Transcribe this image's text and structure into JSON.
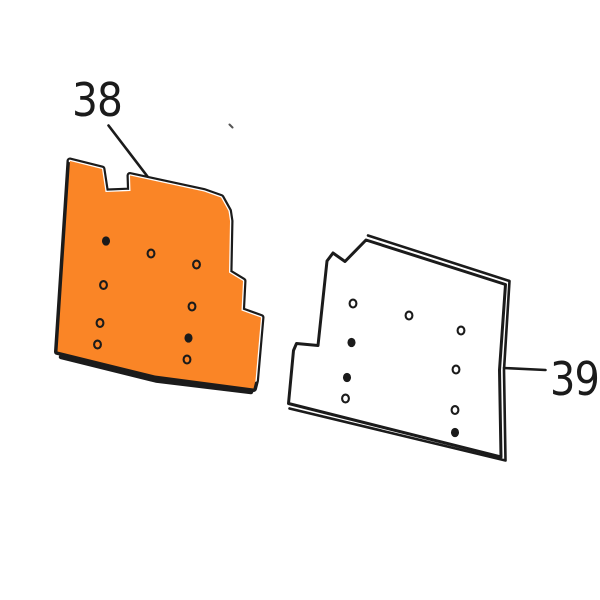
{
  "diagram": {
    "background": "#ffffff",
    "ink_color": "#1b1b1b",
    "stray_mark": {
      "x1": 229.5,
      "y1": 124.5,
      "x2": 232.5,
      "y2": 127.5
    }
  },
  "parts": [
    {
      "part_number": "38",
      "name": "notched mounting panel - highlighted",
      "fill_color": "#fa8526",
      "style": "beveled",
      "outline": [
        [
          70,
          161
        ],
        [
          102,
          169
        ],
        [
          105.5,
          192
        ],
        [
          130.5,
          191
        ],
        [
          130,
          175.5
        ],
        [
          204,
          191.5
        ],
        [
          221,
          197.5
        ],
        [
          228.5,
          211
        ],
        [
          230,
          221
        ],
        [
          229,
          272.5
        ],
        [
          243,
          281
        ],
        [
          241.5,
          310.5
        ],
        [
          261,
          317.5
        ],
        [
          255.5,
          380.5
        ],
        [
          253.5,
          388.5
        ],
        [
          155,
          375.5
        ],
        [
          57.5,
          351.5
        ]
      ],
      "highlight_edge": [
        [
          70,
          161
        ],
        [
          102,
          169
        ],
        [
          105.5,
          192
        ],
        [
          130.5,
          191
        ],
        [
          130,
          175.5
        ],
        [
          204,
          191.5
        ],
        [
          221,
          197.5
        ],
        [
          228.5,
          211
        ],
        [
          230,
          221
        ],
        [
          229,
          272.5
        ],
        [
          243,
          281
        ],
        [
          241.5,
          310.5
        ],
        [
          261,
          317.5
        ],
        [
          255.5,
          380.5
        ]
      ],
      "bottom_shadow": [
        [
          61,
          357
        ],
        [
          156,
          380.5
        ],
        [
          251,
          392
        ]
      ],
      "holes": [
        {
          "x": 106,
          "y": 241,
          "style": "filled"
        },
        {
          "x": 151,
          "y": 253.5,
          "style": "ring"
        },
        {
          "x": 196.5,
          "y": 264.5,
          "style": "ring"
        },
        {
          "x": 103.5,
          "y": 285,
          "style": "ring"
        },
        {
          "x": 192,
          "y": 306.5,
          "style": "ring"
        },
        {
          "x": 100,
          "y": 323,
          "style": "ring"
        },
        {
          "x": 97.5,
          "y": 344.5,
          "style": "ring"
        },
        {
          "x": 188.5,
          "y": 338,
          "style": "filled"
        },
        {
          "x": 187,
          "y": 359.5,
          "style": "ring"
        }
      ],
      "label": {
        "x": 72,
        "y": 116,
        "text_length": 50
      },
      "leader": {
        "x1": 108.5,
        "y1": 125.5,
        "x2": 147.5,
        "y2": 176.5
      }
    },
    {
      "part_number": "39",
      "name": "notched mounting panel - plain",
      "fill_color": "#ffffff",
      "style": "outlined",
      "outline": [
        [
          327,
          261
        ],
        [
          333,
          253
        ],
        [
          345,
          261.5
        ],
        [
          366,
          240
        ],
        [
          505.5,
          284.5
        ],
        [
          499.5,
          370
        ],
        [
          501,
          457
        ],
        [
          288.5,
          403.5
        ],
        [
          293.5,
          350.5
        ],
        [
          296.5,
          343.5
        ],
        [
          318,
          345.5
        ]
      ],
      "thickness_edge": [
        [
          368,
          235.5
        ],
        [
          509.5,
          281
        ],
        [
          504,
          370
        ],
        [
          505.5,
          460.5
        ],
        [
          289.5,
          408.5
        ]
      ],
      "holes": [
        {
          "x": 353,
          "y": 303.5,
          "style": "ring"
        },
        {
          "x": 409,
          "y": 315.5,
          "style": "ring"
        },
        {
          "x": 461,
          "y": 330.5,
          "style": "ring"
        },
        {
          "x": 351.5,
          "y": 342.5,
          "style": "filled"
        },
        {
          "x": 456,
          "y": 369.5,
          "style": "ring"
        },
        {
          "x": 347,
          "y": 377.5,
          "style": "filled"
        },
        {
          "x": 345.5,
          "y": 398.5,
          "style": "ring"
        },
        {
          "x": 455,
          "y": 410,
          "style": "ring"
        },
        {
          "x": 455,
          "y": 432.5,
          "style": "filled"
        }
      ],
      "label": {
        "x": 550,
        "y": 395,
        "text_length": 49
      },
      "leader": {
        "x1": 504,
        "y1": 368,
        "x2": 545.5,
        "y2": 370
      }
    }
  ]
}
